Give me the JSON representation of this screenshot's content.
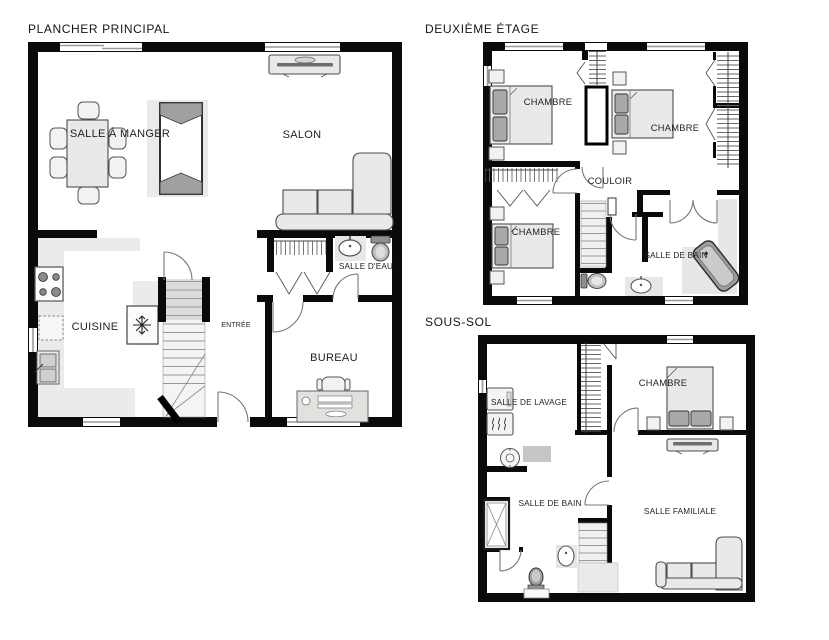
{
  "document": {
    "type": "floor-plan-set",
    "language": "fr"
  },
  "floors": {
    "main": {
      "title": "PLANCHER PRINCIPAL",
      "labels": {
        "dining": "SALLE À MANGER",
        "living": "SALON",
        "kitchen": "CUISINE",
        "entrance": "ENTRÉE",
        "powder_room": "SALLE D'EAU",
        "office": "BUREAU"
      }
    },
    "second": {
      "title": "DEUXIÈME ÉTAGE",
      "labels": {
        "bedroom_top_left": "CHAMBRE",
        "bedroom_top_right": "CHAMBRE",
        "bedroom_bottom": "CHAMBRE",
        "hallway": "COULOIR",
        "bathroom": "SALLE DE BAIN"
      }
    },
    "basement": {
      "title": "SOUS-SOL",
      "labels": {
        "laundry": "SALLE DE LAVAGE",
        "bedroom": "CHAMBRE",
        "bathroom": "SALLE DE BAIN",
        "family_room": "SALLE FAMILIALE"
      }
    }
  },
  "colors": {
    "background": "#ffffff",
    "wall": "#0a0a0a",
    "furniture_fill": "#e9e9e7",
    "furniture_stroke": "#4d4d4d",
    "accent_gray": "#a9a9a9",
    "label_text": "#1f1f1f",
    "door_arc": "#777777",
    "window_line": "#9a9a9a"
  }
}
